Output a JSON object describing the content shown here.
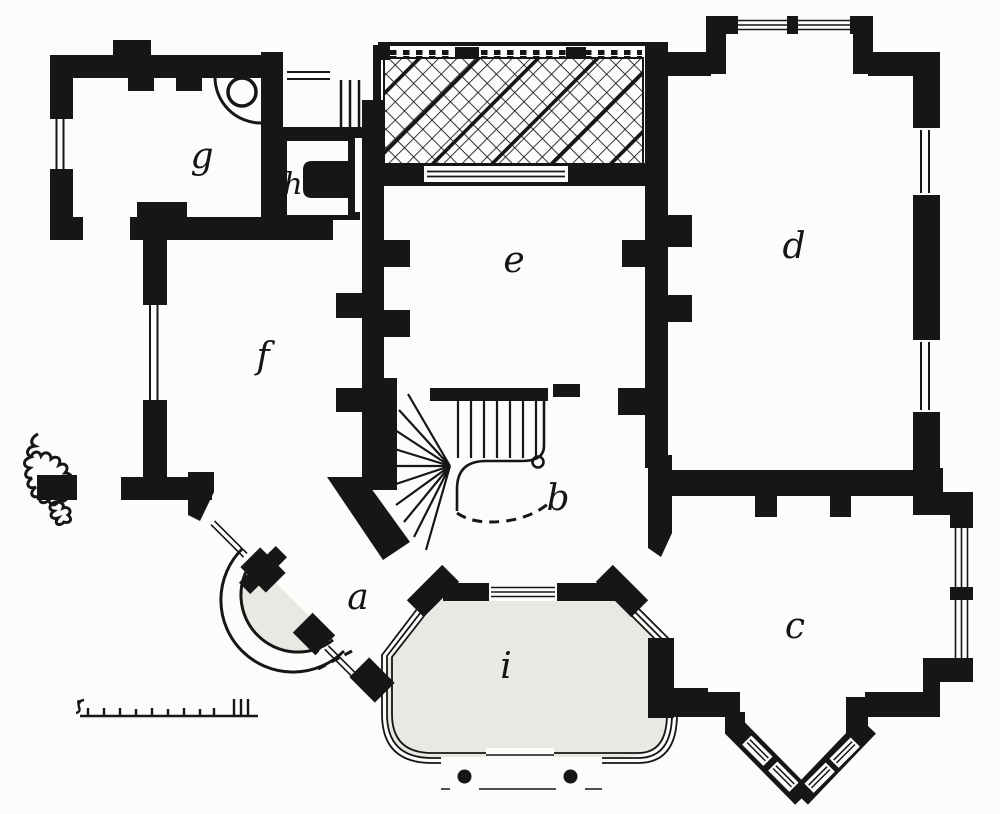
{
  "figure": {
    "type": "architectural-floor-plan",
    "description": "Scanned ground-floor plan of a villa; rooms marked with italic letters, cross-hatched terrace at top, winder staircase in the centre, semicircular entrance steps, polygonal glazed veranda at the bottom and a pointed bay window at lower right. A small sketch of a shrub sits at the left edge and a graphic scale bar at the lower left.",
    "ink_color": "#161616",
    "paper_color": "#fcfcfa",
    "shade_color": "#e9e8e2"
  },
  "rooms": [
    {
      "id": "a",
      "label": "a"
    },
    {
      "id": "b",
      "label": "b"
    },
    {
      "id": "c",
      "label": "c"
    },
    {
      "id": "d",
      "label": "d"
    },
    {
      "id": "e",
      "label": "e"
    },
    {
      "id": "f",
      "label": "f"
    },
    {
      "id": "g",
      "label": "g"
    },
    {
      "id": "h",
      "label": "h"
    },
    {
      "id": "i",
      "label": "i"
    }
  ]
}
